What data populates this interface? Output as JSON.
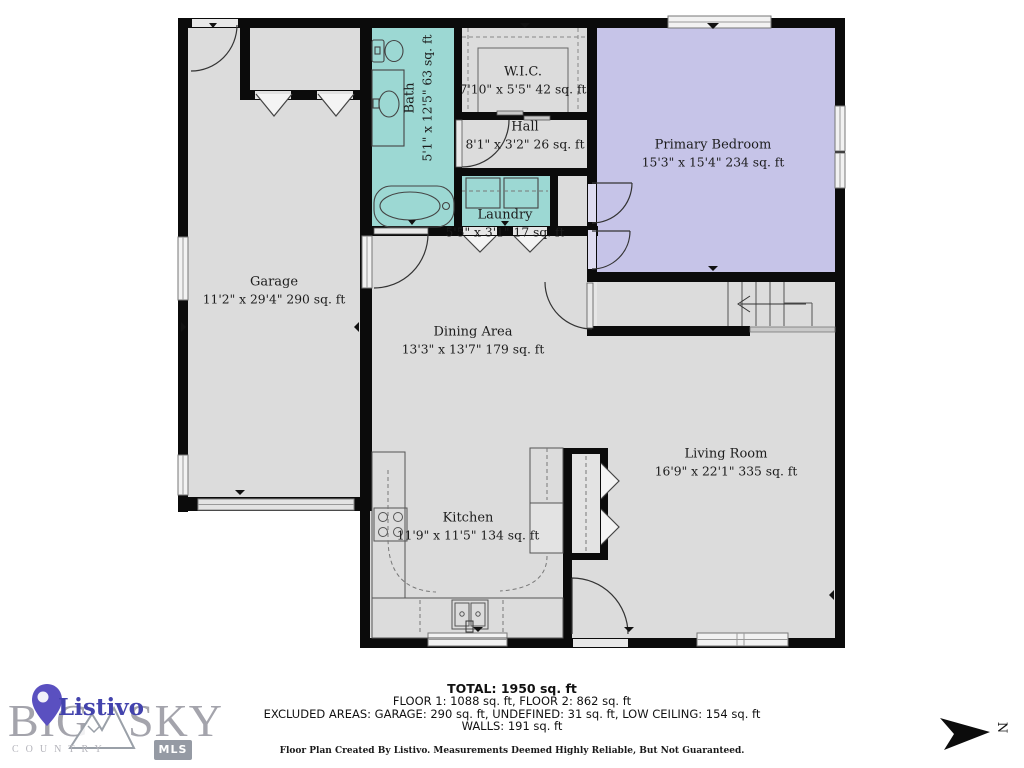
{
  "colors": {
    "wall": "#0b0b0b",
    "floor_gray": "#dcdcdc",
    "bath_teal": "#9cd8d3",
    "bedroom_lavender": "#c6c4e8",
    "logo_gray": "#a4a4ac",
    "listivo_purple": "#4343ad"
  },
  "rooms": [
    {
      "key": "garage",
      "name": "Garage",
      "dims": "11'2\" x 29'4\" 290 sq. ft"
    },
    {
      "key": "bath",
      "name": "Bath",
      "dims": "5'1\" x 12'5\" 63 sq. ft"
    },
    {
      "key": "wic",
      "name": "W.I.C.",
      "dims": "7'10\" x 5'5\" 42 sq. ft"
    },
    {
      "key": "hall",
      "name": "Hall",
      "dims": "8'1\" x 3'2\" 26 sq. ft"
    },
    {
      "key": "laundry",
      "name": "Laundry",
      "dims": "5'5\" x 3'1\" 17 sq. ft"
    },
    {
      "key": "primary",
      "name": "Primary Bedroom",
      "dims": "15'3\" x 15'4\" 234 sq. ft"
    },
    {
      "key": "dining",
      "name": "Dining Area",
      "dims": "13'3\" x 13'7\" 179 sq. ft"
    },
    {
      "key": "kitchen",
      "name": "Kitchen",
      "dims": "11'9\" x 11'5\" 134 sq. ft"
    },
    {
      "key": "living",
      "name": "Living Room",
      "dims": "16'9\" x 22'1\" 335 sq. ft"
    }
  ],
  "summary": {
    "total": "TOTAL: 1950 sq. ft",
    "floors": "FLOOR 1: 1088 sq. ft, FLOOR 2: 862 sq. ft",
    "excluded": "EXCLUDED AREAS: GARAGE: 290 sq. ft, UNDEFINED: 31 sq. ft, LOW CEILING: 154 sq. ft",
    "walls": "WALLS: 191 sq. ft",
    "disclaimer": "Floor Plan Created By Listivo. Measurements Deemed Highly Reliable, But Not Guaranteed."
  },
  "branding": {
    "listivo": "Listivo",
    "big": "BIG",
    "sky": "SKY",
    "country": "COUNTRY",
    "mls": "MLS"
  },
  "compass": {
    "north_label": "N"
  }
}
